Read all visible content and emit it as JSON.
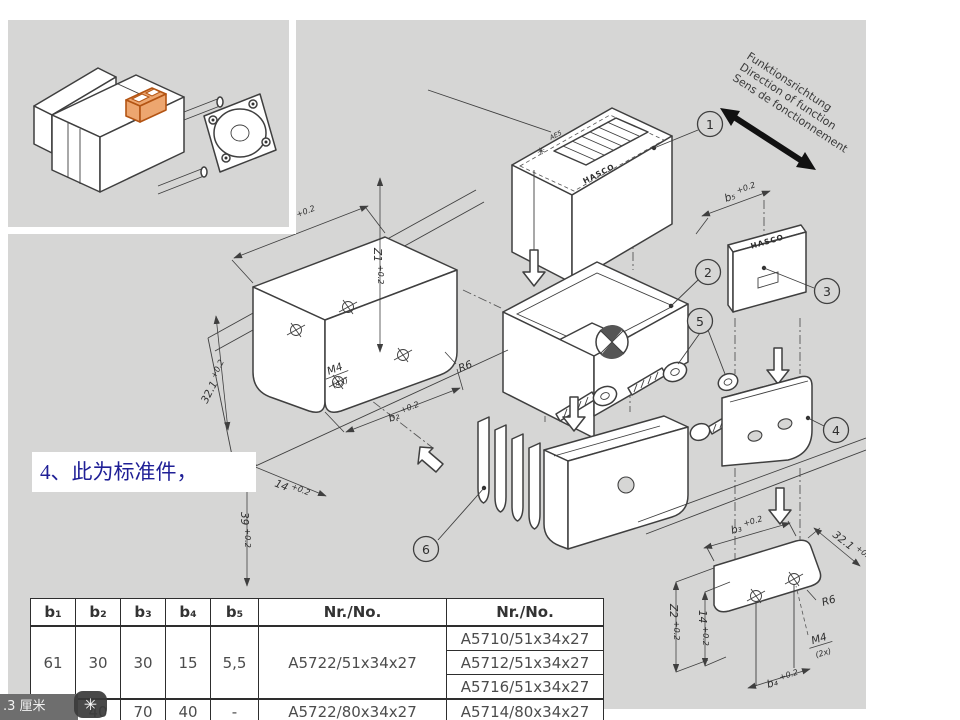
{
  "labels": {
    "funk1": "Funktionsrichtung",
    "funk2": "Direction of function",
    "funk3": "Sens de fonctionnement",
    "brand": "HASCO",
    "model": "AE5",
    "star": "✳"
  },
  "callouts": {
    "c1": "1",
    "c2": "2",
    "c3": "3",
    "c4": "4",
    "c5": "5",
    "c6": "6"
  },
  "dims": {
    "b1": "b₁",
    "b2": "b₂",
    "b3": "b₃",
    "b4": "b₄",
    "b5": "b₅",
    "z1": "Z1",
    "z2": "Z2",
    "d321": "32.1",
    "d39": "39",
    "d14": "14",
    "tol": "+0.2",
    "m4": "M4",
    "x4": "(4x)",
    "x2": "(2x)",
    "r6": "R6"
  },
  "annotation": {
    "text": "4、此为标准件，"
  },
  "statusbar": {
    "text": ".3 厘米"
  },
  "cursor": {
    "glyph": "✳"
  },
  "table": {
    "headers": [
      "b₁",
      "b₂",
      "b₃",
      "b₄",
      "b₅",
      "Nr./No.",
      "Nr./No."
    ],
    "g1": {
      "b1": "61",
      "b2": "30",
      "b3": "30",
      "b4": "15",
      "b5": "5,5",
      "nr": "A5722/51x34x27",
      "nrs": [
        "A5710/51x34x27",
        "A5712/51x34x27",
        "A5716/51x34x27"
      ]
    },
    "g2": {
      "b1": "90",
      "b2": "40",
      "b3": "70",
      "b4": "40",
      "b5": "-",
      "nr": "A5722/80x34x27",
      "nrs": [
        "A5714/80x34x27"
      ]
    }
  }
}
